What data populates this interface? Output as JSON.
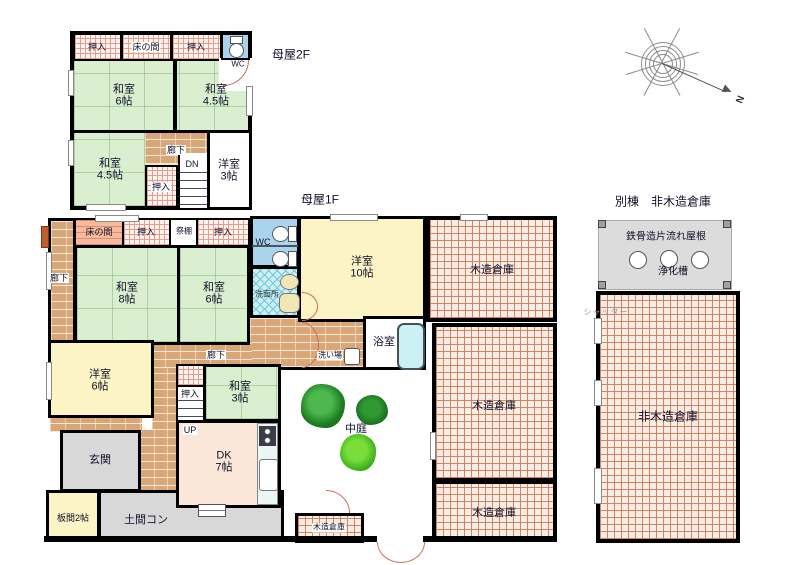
{
  "floor2": {
    "title": "母屋2F",
    "oshiire_left": "押入",
    "tokonoma": "床の間",
    "oshiire_right": "押入",
    "wc": "WC",
    "washitsu_6": "和室\n6帖",
    "washitsu_45_ne": "和室\n4.5帖",
    "rouka": "廊下",
    "dn": "DN",
    "oshiire_stairs": "押入",
    "washitsu_45_sw": "和室\n4.5帖",
    "youshitsu_3": "洋室\n3帖"
  },
  "floor1": {
    "title": "母屋1F",
    "rouka_west": "廊下",
    "tokonoma": "床の間",
    "oshiire_n1": "押入",
    "saidana": "祭棚",
    "oshiire_n2": "押入",
    "wc": "WC",
    "senmenjo": "洗面所",
    "washitsu_8": "和室\n8帖",
    "washitsu_6": "和室\n6帖",
    "youshitsu_10": "洋室\n10帖",
    "yokushitsu": "浴室",
    "araiba": "洗い場",
    "rouka_center": "廊下",
    "oshiire_stairs": "押入",
    "up": "UP",
    "youshitsu_6": "洋室\n6帖",
    "washitsu_3": "和室\n3帖",
    "genkan": "玄関",
    "dk": "DK\n7帖",
    "itanoma": "板間2帖",
    "doma": "土間コン",
    "nakaniwa": "中庭",
    "mokuzo_ne": "木造倉庫",
    "mokuzo_e": "木造倉庫",
    "mokuzo_se": "木造倉庫",
    "mokuzo_s": "木造倉庫"
  },
  "annex": {
    "title": "別棟　非木造倉庫",
    "roof": "鉄骨造片流れ屋根",
    "septic_tank": "浄化槽",
    "warehouse": "非木造倉庫",
    "shutter": "シャッター"
  },
  "compass": {
    "north_label": "N"
  },
  "colors": {
    "tatami_green": "#d9efcf",
    "wood_corridor": "#d9a678",
    "closet_hatch": "#e79d8d",
    "warehouse_hatch": "#cd8660",
    "water_blue": "#a9d4ec",
    "room_yellow": "#fcf4c4",
    "dk_pink": "#fbe7da",
    "entrance_gray": "#d8d8d8",
    "door_arc": "#c9705a",
    "tree_dark": "#1e7e22",
    "tree_light": "#4fc426"
  }
}
